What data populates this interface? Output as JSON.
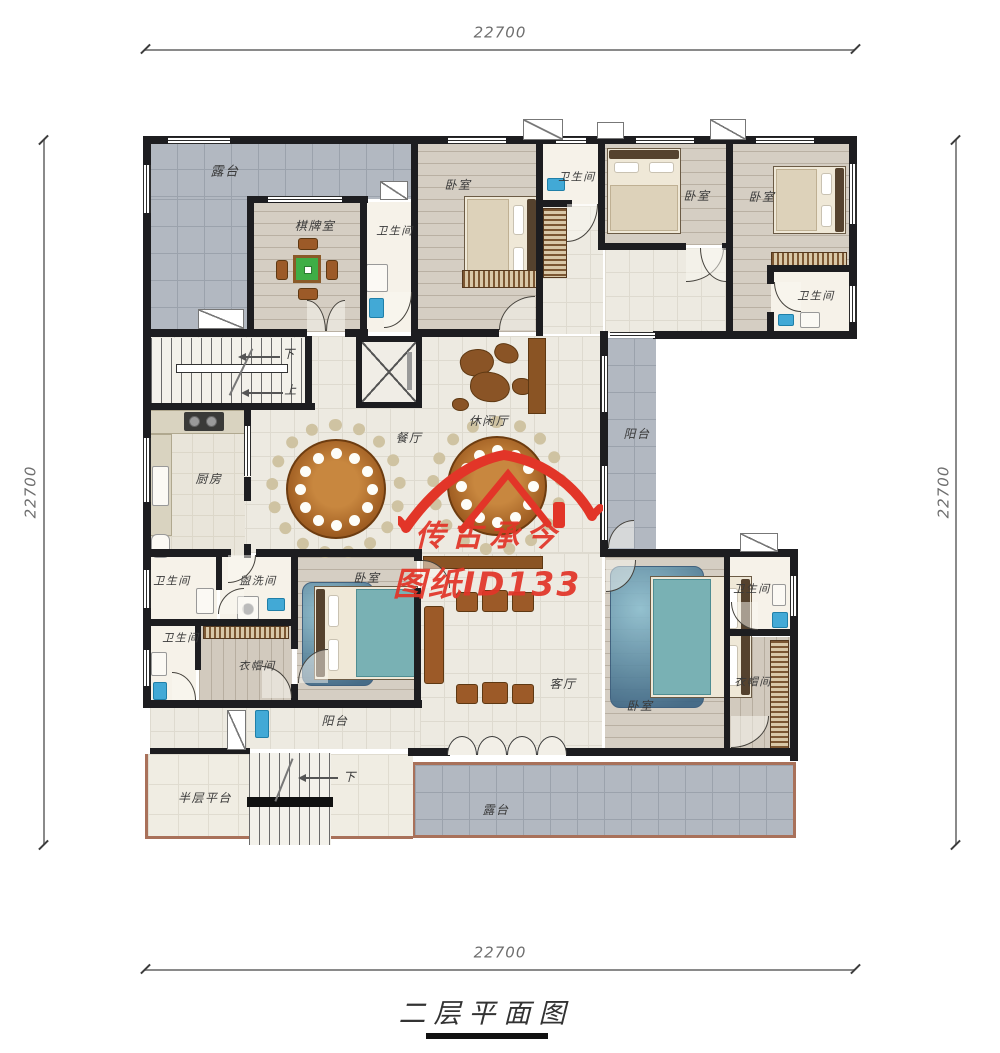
{
  "title": "二层平面图",
  "dimensions": {
    "top": "22700",
    "bottom": "22700",
    "left": "22700",
    "right": "22700"
  },
  "watermark": {
    "line1": "传古承今",
    "line2": "图纸ID133",
    "color": "#e23528"
  },
  "stairs": {
    "down": "下",
    "up": "上",
    "lower_down": "下"
  },
  "rooms": {
    "terrace_tl": "露台",
    "chess_room": "棋牌室",
    "bath_tl": "卫生间",
    "bedroom_t1": "卧室",
    "bath_tm": "卫生间",
    "bedroom_t2": "卧室",
    "bedroom_t3": "卧室",
    "bath_tr": "卫生间",
    "dining": "餐厅",
    "lounge": "休闲厅",
    "balcony_right": "阳台",
    "kitchen": "厨房",
    "bath_a": "卫生间",
    "washroom": "盥洗间",
    "bedroom_left": "卧室",
    "bath_b": "卫生间",
    "cloak_a": "衣帽间",
    "balcony_bottom": "阳台",
    "living": "客厅",
    "bedroom_right": "卧室",
    "bath_r": "卫生间",
    "cloak_b": "衣帽间",
    "half_platform": "半层平台",
    "terrace_bottom": "露台"
  },
  "colors": {
    "wall": "#1d1d20",
    "terrace_tile": "#b2b8c1",
    "watermark_red": "#e23528",
    "wood_accent": "#a15f23"
  }
}
